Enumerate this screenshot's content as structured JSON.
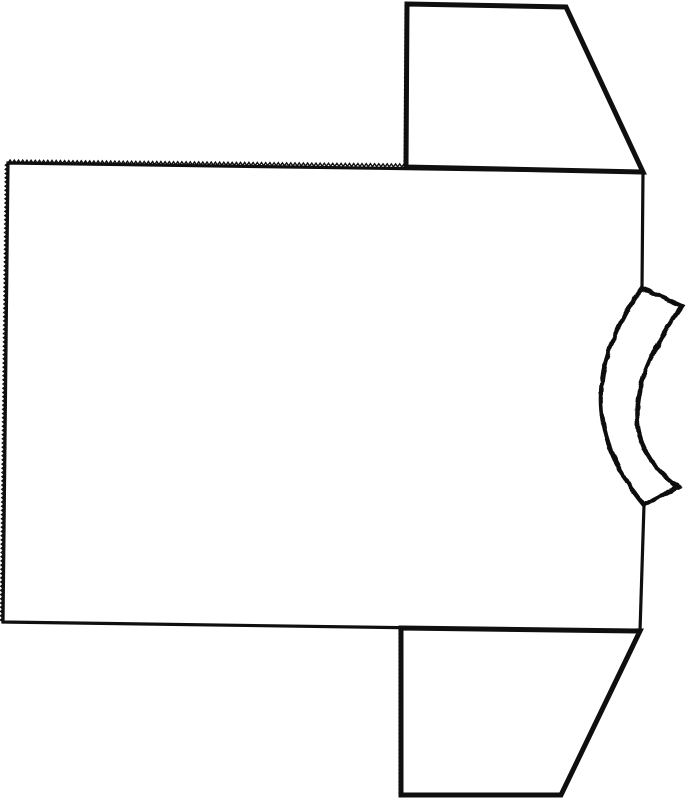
{
  "drawing": {
    "description": "Black-and-white line drawing of a short-sleeved T-shirt lying sideways, sewing-pattern style: large rectangular body panel with pinked serrated top and left edges, trapezoidal sleeves attached at the upper-right and lower-right, and a rough-cut curved neckband crescent on the middle of the right edge.",
    "background": "#ffffff",
    "ink": "#0f0f0f",
    "canvas": {
      "width": 687,
      "height": 800
    },
    "shapes": [
      {
        "name": "body-panel-outline",
        "type": "polyline",
        "points": [
          [
            642,
            288
          ],
          [
            643,
            172
          ],
          [
            8,
            163
          ],
          [
            3,
            622
          ],
          [
            640,
            631
          ],
          [
            644,
            505
          ]
        ],
        "stroke_width": 3.2
      },
      {
        "name": "top-sleeve",
        "type": "polygon",
        "points": [
          [
            407,
            4
          ],
          [
            566,
            7
          ],
          [
            643,
            172
          ],
          [
            406,
            167
          ]
        ],
        "stroke_width": 5
      },
      {
        "name": "bottom-sleeve",
        "type": "polygon",
        "points": [
          [
            401,
            628
          ],
          [
            640,
            631
          ],
          [
            561,
            795
          ],
          [
            401,
            795
          ]
        ],
        "stroke_width": 5
      },
      {
        "name": "neck-band",
        "type": "path",
        "d": "M 642 288 Q 559 403 644 505 L 678 487 Q 594 427 682 306 Z",
        "fill": "#ffffff",
        "stroke_width": 4.5,
        "rough": true
      },
      {
        "name": "pinked-edge-body-top",
        "type": "zigzag",
        "from": [
          8,
          163
        ],
        "to": [
          406,
          167
        ],
        "pitch": 4.2,
        "amplitude": 3.0,
        "stroke_width": 1.4
      },
      {
        "name": "pinked-edge-body-left",
        "type": "zigzag",
        "from": [
          3,
          622
        ],
        "to": [
          8,
          163
        ],
        "pitch": 4.2,
        "amplitude": 2.6,
        "stroke_width": 1.4
      },
      {
        "name": "pinked-edge-top-sleeve-left",
        "type": "zigzag",
        "from": [
          406,
          167
        ],
        "to": [
          407,
          4
        ],
        "pitch": 4.0,
        "amplitude": 2.0,
        "stroke_width": 1.2
      },
      {
        "name": "pinked-edge-bottom-sleeve-left",
        "type": "zigzag",
        "from": [
          401,
          795
        ],
        "to": [
          401,
          628
        ],
        "pitch": 4.0,
        "amplitude": 2.0,
        "stroke_width": 1.2
      }
    ]
  }
}
